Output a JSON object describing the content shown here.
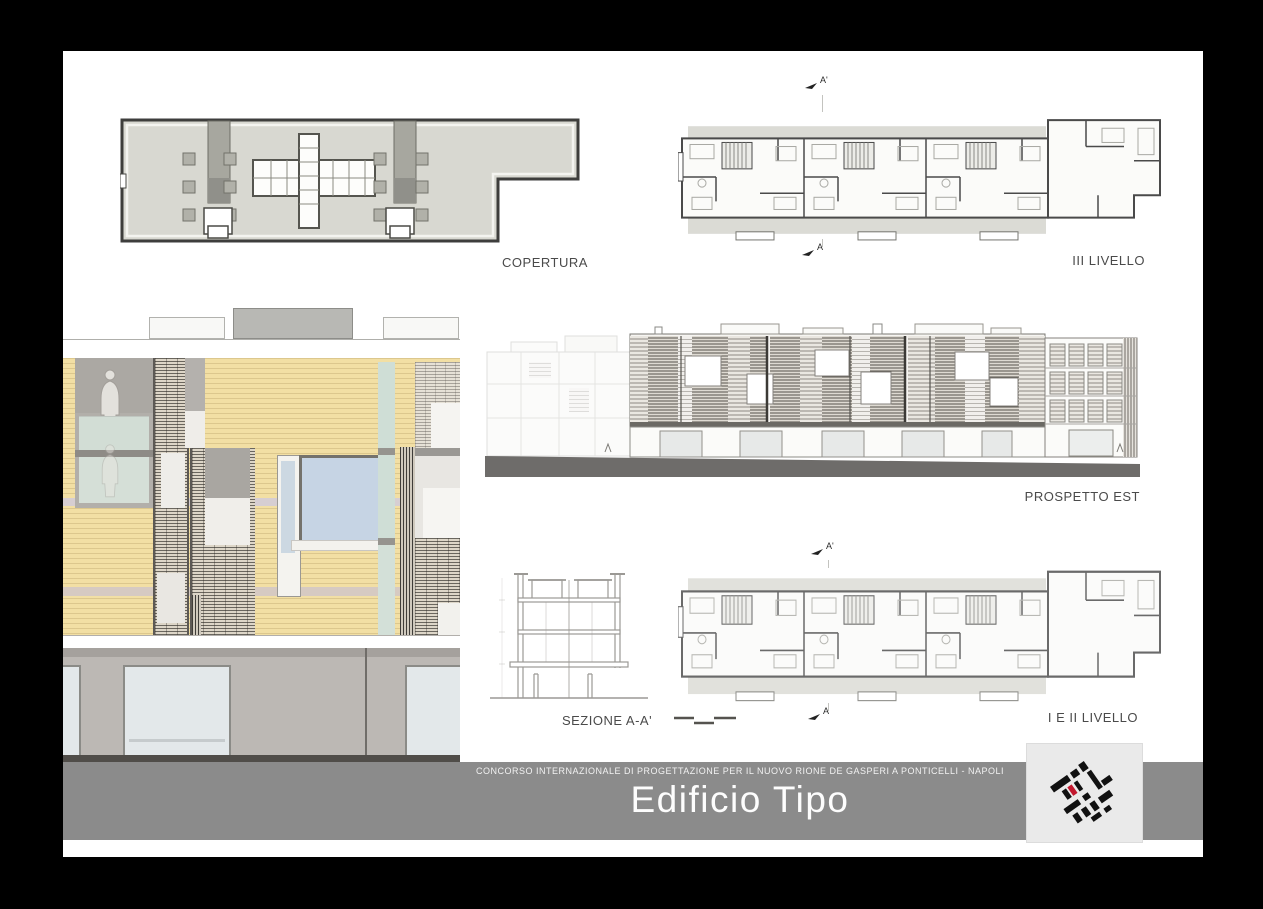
{
  "drawings": {
    "copertura": {
      "label": "COPERTURA"
    },
    "livello3": {
      "label": "III LIVELLO",
      "marker_top": "A'",
      "marker_bottom": "A"
    },
    "prospetto_est": {
      "label": "PROSPETTO EST"
    },
    "sezione": {
      "label": "SEZIONE A-A'"
    },
    "livello12": {
      "label": "I E II LIVELLO",
      "marker_top": "A'",
      "marker_bottom": "A"
    }
  },
  "footer": {
    "competition": "CONCORSO INTERNAZIONALE DI PROGETTAZIONE PER IL NUOVO RIONE DE GASPERI A PONTICELLI - NAPOLI",
    "title": "Edificio Tipo",
    "logo_icon": "masterplan-logo"
  },
  "palette": {
    "band_gray": "#8b8b8b",
    "wood_tan": "#f2dfa4",
    "glass_blue": "#c6d4e4",
    "glass_green": "#cfded6",
    "ground_gray": "#bcb8b4",
    "plan_fill": "#d8d8d1",
    "line_dark": "#4a4a4a",
    "logo_red": "#c2182e"
  }
}
